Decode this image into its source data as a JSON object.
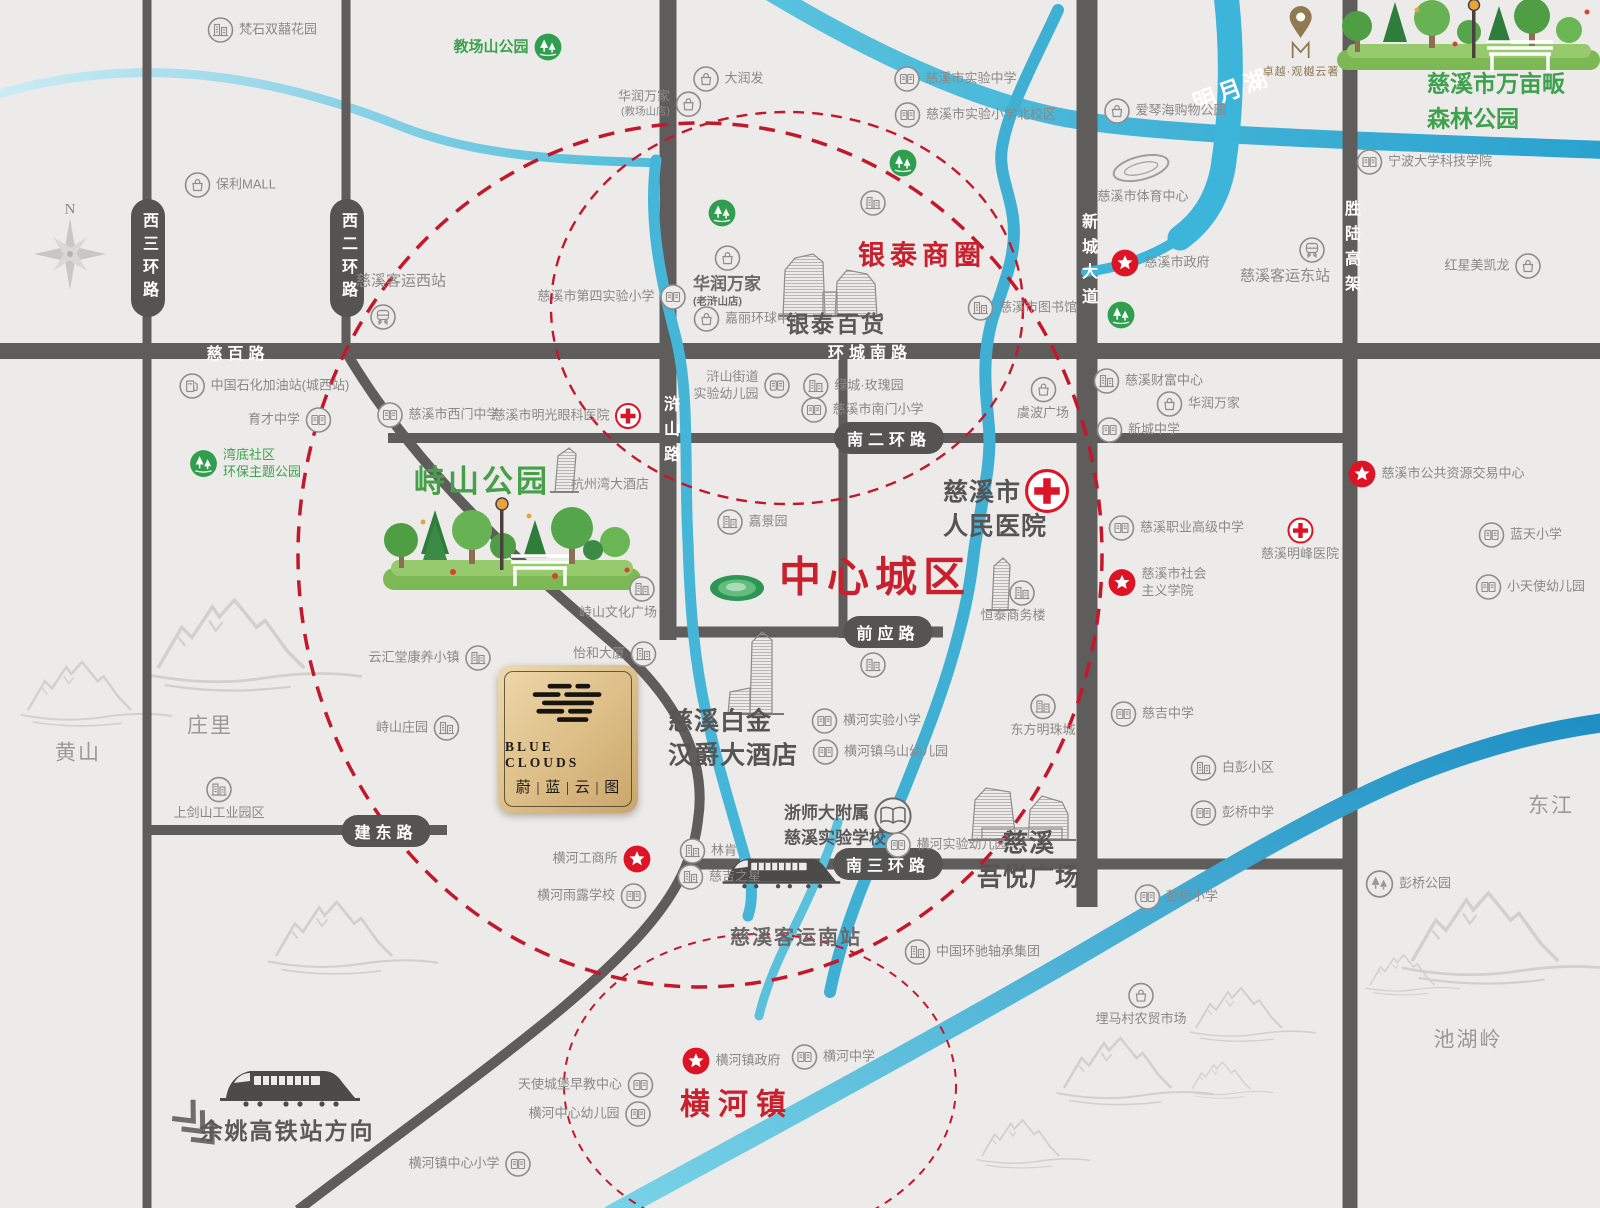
{
  "plaque": {
    "en": "BLUE CLOUDS",
    "zh": "蔚 | 蓝 | 云 | 图"
  },
  "pin": {
    "label": "卓越·观樾云著"
  },
  "road_labels": [
    {
      "n": "xisan-huanlu",
      "t": "西三环路",
      "k": "pv",
      "x": 148,
      "y": 258
    },
    {
      "n": "xier-huanlu",
      "t": "西二环路",
      "k": "pv",
      "x": 347,
      "y": 258
    },
    {
      "n": "cibai-lu",
      "t": "慈百路",
      "k": "rh",
      "x": 238,
      "y": 352
    },
    {
      "n": "huancheng-nanlu",
      "t": "环城南路",
      "k": "rh",
      "x": 870,
      "y": 351
    },
    {
      "n": "hushan-lu",
      "t": "浒山路",
      "k": "rv",
      "x": 669,
      "y": 433
    },
    {
      "n": "xincheng-dadao",
      "t": "新城大道",
      "k": "rv",
      "x": 1087,
      "y": 263
    },
    {
      "n": "shenglu-gaojia",
      "t": "胜陆高架",
      "k": "rv",
      "x": 1350,
      "y": 250
    },
    {
      "n": "naner-huanlu",
      "t": "南二环路",
      "k": "ph",
      "x": 889,
      "y": 438
    },
    {
      "n": "qianying-lu",
      "t": "前应路",
      "k": "ph",
      "x": 888,
      "y": 632
    },
    {
      "n": "nansan-huanlu",
      "t": "南三环路",
      "k": "ph",
      "x": 888,
      "y": 864
    },
    {
      "n": "jiandong-lu",
      "t": "建东路",
      "k": "ph",
      "x": 386,
      "y": 831
    },
    {
      "n": "mingyuehu",
      "t": "明月湖",
      "k": "wl",
      "x": 1231,
      "y": 88,
      "rot": -20
    }
  ],
  "pois": [
    {
      "n": "fanshi-shuangxi-huayuan",
      "t": "梵石双囍花园",
      "i": "building",
      "ip": "l",
      "x": 262,
      "y": 30
    },
    {
      "n": "baoli-mall",
      "t": "保利MALL",
      "i": "bag",
      "ip": "l",
      "x": 230,
      "y": 185
    },
    {
      "n": "compass-label",
      "t": "N",
      "x": 70,
      "y": 210,
      "c": "compass-n"
    },
    {
      "n": "jiaochangshan-gongyuan",
      "t": "教场山公园",
      "i": "park",
      "ip": "r",
      "x": 508,
      "y": 47,
      "c": "green-md"
    },
    {
      "n": "darunfa",
      "t": "大润发",
      "i": "bag",
      "ip": "l",
      "x": 728,
      "y": 79
    },
    {
      "n": "huarun-wanjia-jiaochangshan",
      "t": "华润万家",
      "s": "(教场山店)",
      "i": "bag",
      "ip": "r",
      "x": 660,
      "y": 104,
      "la": "r"
    },
    {
      "n": "cixi-keyun-xizhan",
      "t": "慈溪客运西站",
      "x": 401,
      "y": 281,
      "c": "gray-md"
    },
    {
      "n": "xizhan-train",
      "i": "train",
      "x": 383,
      "y": 317
    },
    {
      "n": "cixi-disi-shiyan-xiaoxue",
      "t": "慈溪市第四实验小学",
      "i": "school",
      "ip": "r",
      "x": 612,
      "y": 297
    },
    {
      "n": "jiali-huanqiu-zhongxin",
      "t": "嘉丽环球中心",
      "i": "bag",
      "ip": "l",
      "x": 748,
      "y": 319
    },
    {
      "n": "huarun-wanjia-laohushan",
      "t": "华润万家",
      "s": "(老浒山店)",
      "i": "bag",
      "ip": "a",
      "x": 727,
      "y": 277,
      "c": "hd",
      "la": "l"
    },
    {
      "n": "yintai-baihuo",
      "t": "银泰百货",
      "x": 836,
      "y": 325,
      "c": "dark-lg"
    },
    {
      "n": "cixi-shiyan-zhongxue",
      "t": "慈溪市实验中学",
      "i": "school",
      "ip": "l",
      "x": 955,
      "y": 79
    },
    {
      "n": "cixi-shiyan-xiaoxue-beixiaoqu",
      "t": "慈溪市实验小学北校区",
      "i": "school",
      "ip": "l",
      "x": 975,
      "y": 115
    },
    {
      "n": "aiqinhai-gouwu-gongyuan",
      "t": "爱琴海购物公园",
      "i": "bag",
      "ip": "l",
      "x": 1165,
      "y": 111
    },
    {
      "n": "yintai-shangquan",
      "t": "银泰商圈",
      "x": 922,
      "y": 256,
      "c": "red-lg"
    },
    {
      "n": "cixi-tiyu-zhongxin",
      "t": "慈溪市体育中心",
      "x": 1143,
      "y": 197
    },
    {
      "n": "cixi-zhengfu",
      "t": "慈溪市政府",
      "i": "star",
      "ip": "l",
      "x": 1160,
      "y": 263
    },
    {
      "n": "cixi-keyun-dongzhan",
      "t": "慈溪客运东站",
      "x": 1285,
      "y": 276,
      "c": "gray-md"
    },
    {
      "n": "dongzhan-train",
      "i": "train",
      "x": 1312,
      "y": 250
    },
    {
      "n": "cixi-wanmupan-senlin-gongyuan",
      "t": "慈溪市万亩畈",
      "t2": "森林公园",
      "x": 1496,
      "y": 101,
      "c": "green-hd",
      "la": "l"
    },
    {
      "n": "ningbo-daxue-keji-xueyuan",
      "t": "宁波大学科技学院",
      "i": "school",
      "ip": "l",
      "x": 1424,
      "y": 162
    },
    {
      "n": "hongxing-meikailong",
      "t": "红星美凯龙",
      "i": "bag",
      "ip": "r",
      "x": 1493,
      "y": 266
    },
    {
      "n": "zhongguo-shihua-jiayouzhan",
      "t": "中国石化加油站(城西站)",
      "i": "gas",
      "ip": "l",
      "x": 264,
      "y": 386
    },
    {
      "n": "yucai-zhongxue",
      "t": "育才中学",
      "i": "school",
      "ip": "r",
      "x": 290,
      "y": 420
    },
    {
      "n": "wandi-shequ-huanbao-gongyuan",
      "t": "湾底社区",
      "t2": "环保主题公园",
      "i": "park",
      "ip": "l",
      "x": 245,
      "y": 464,
      "c": "green",
      "la": "l"
    },
    {
      "n": "cixi-ximen-zhongxue",
      "t": "慈溪市西门中学",
      "i": "school",
      "ip": "l",
      "x": 438,
      "y": 415
    },
    {
      "n": "cixi-mingguang-yanke-yiyuan",
      "t": "慈溪市明光眼科医院",
      "i": "cross",
      "ip": "r",
      "x": 567,
      "y": 416
    },
    {
      "n": "hushan-jiedao-shiyan-youeryuan",
      "t": "浒山街道",
      "t2": "实验幼儿园",
      "i": "school",
      "ip": "r",
      "x": 742,
      "y": 386,
      "la": "r"
    },
    {
      "n": "lvcheng-meiguiyuan",
      "t": "绿城·玫瑰园",
      "i": "building",
      "ip": "l",
      "x": 853,
      "y": 386
    },
    {
      "n": "cixi-nanmen-xiaoxue",
      "t": "慈溪市南门小学",
      "i": "school",
      "ip": "l",
      "x": 862,
      "y": 410
    },
    {
      "n": "yubo-guangchang",
      "t": "虞波广场",
      "i": "bag",
      "ip": "a",
      "x": 1043,
      "y": 399
    },
    {
      "n": "cixi-tushuguan",
      "t": "慈溪市图书馆",
      "i": "building",
      "ip": "l",
      "x": 1022,
      "y": 308
    },
    {
      "n": "cixi-caifu-zhongxin",
      "t": "慈溪财富中心",
      "i": "building",
      "ip": "l",
      "x": 1148,
      "y": 381
    },
    {
      "n": "huarun-wanjia",
      "t": "华润万家",
      "i": "bag",
      "ip": "l",
      "x": 1198,
      "y": 404
    },
    {
      "n": "xincheng-zhongxue",
      "t": "新城中学",
      "i": "school",
      "ip": "l",
      "x": 1138,
      "y": 430
    },
    {
      "n": "cixi-gonggong-ziyuan-jiaoyi-zhongxin",
      "t": "慈溪市公共资源交易中心",
      "i": "star",
      "ip": "l",
      "x": 1436,
      "y": 474
    },
    {
      "n": "lantian-xiaoxue",
      "t": "蓝天小学",
      "i": "school",
      "ip": "l",
      "x": 1520,
      "y": 535
    },
    {
      "n": "xiaotianshi-youeryuan",
      "t": "小天使幼儿园",
      "i": "school",
      "ip": "l",
      "x": 1530,
      "y": 587
    },
    {
      "n": "cixi-zhiye-gaoji-zhongxue",
      "t": "慈溪职业高级中学",
      "i": "school",
      "ip": "l",
      "x": 1176,
      "y": 528
    },
    {
      "n": "cixi-mingfeng-yiyuan",
      "t": "慈溪明峰医院",
      "i": "cross",
      "ip": "a",
      "x": 1300,
      "y": 540
    },
    {
      "n": "cixi-shehuizhuyi-xueyuan",
      "t": "慈溪市社会",
      "t2": "主义学院",
      "i": "star",
      "ip": "l",
      "x": 1157,
      "y": 583,
      "la": "l"
    },
    {
      "n": "zhishan-gongyuan",
      "t": "峙山公园",
      "x": 482,
      "y": 482,
      "c": "green-xl"
    },
    {
      "n": "hangzhouwan-dajiudian",
      "t": "杭州湾大酒店",
      "x": 610,
      "y": 485
    },
    {
      "n": "jiajingyuan",
      "t": "嘉景园",
      "i": "building",
      "ip": "l",
      "x": 752,
      "y": 522
    },
    {
      "n": "zhongxin-chengqu",
      "t": "中心城区",
      "x": 875,
      "y": 578,
      "c": "red-xl"
    },
    {
      "n": "cixi-renmin-yiyuan",
      "t": "慈溪市",
      "t2": "人民医院",
      "x": 995,
      "y": 510,
      "c": "dark-xl",
      "la": "l"
    },
    {
      "n": "renmin-yiyuan-cross",
      "i": "cross-lg",
      "x": 1047,
      "y": 491
    },
    {
      "n": "hengtai-shangwulou",
      "t": "恒泰商务楼",
      "x": 1013,
      "y": 616
    },
    {
      "n": "hengtai-icon",
      "i": "building",
      "x": 1022,
      "y": 593
    },
    {
      "n": "zhishan-wenhua-guangchang",
      "t": "峙山文化广场",
      "x": 618,
      "y": 613
    },
    {
      "n": "zhishan-wenhua-guangchang-icon",
      "i": "building",
      "x": 642,
      "y": 589
    },
    {
      "n": "yihe-dasha",
      "t": "怡和大厦",
      "i": "building",
      "ip": "r",
      "x": 615,
      "y": 654
    },
    {
      "n": "yunhuitang-kangyang-xiaozhen",
      "t": "云汇堂康养小镇",
      "i": "building",
      "ip": "r",
      "x": 430,
      "y": 658
    },
    {
      "n": "zhishan-zhuangyuan",
      "t": "峙山庄园",
      "i": "building",
      "ip": "r",
      "x": 418,
      "y": 728
    },
    {
      "n": "cixi-baijin-hanjue-dajiudian",
      "t": "慈溪白金",
      "t2": "汉爵大酒店",
      "x": 733,
      "y": 739,
      "c": "dark-xl",
      "la": "l"
    },
    {
      "n": "henghe-shiyan-xiaoxue",
      "t": "横河实验小学",
      "i": "school",
      "ip": "l",
      "x": 866,
      "y": 721
    },
    {
      "n": "henghezhen-wushan-youeryuan",
      "t": "横河镇乌山幼儿园",
      "i": "school",
      "ip": "l",
      "x": 880,
      "y": 752
    },
    {
      "n": "dongfang-mingzhucheng",
      "t": "东方明珠城",
      "i": "building",
      "ip": "a",
      "x": 1043,
      "y": 716
    },
    {
      "n": "ciji-zhongxue",
      "t": "慈吉中学",
      "i": "school",
      "ip": "l",
      "x": 1152,
      "y": 714
    },
    {
      "n": "baipeng-xiaoqu",
      "t": "白彭小区",
      "i": "building",
      "ip": "l",
      "x": 1232,
      "y": 768
    },
    {
      "n": "pengqiao-zhongxue",
      "t": "彭桥中学",
      "i": "school",
      "ip": "l",
      "x": 1232,
      "y": 813
    },
    {
      "n": "huangshan",
      "t": "黄山",
      "x": 78,
      "y": 753,
      "c": "gray-lg"
    },
    {
      "n": "zhuangli",
      "t": "庄里",
      "x": 210,
      "y": 726,
      "c": "gray-lg"
    },
    {
      "n": "shangjianshan-gongye-yuanqu",
      "t": "上剑山工业园区",
      "i": "building",
      "ip": "a",
      "x": 219,
      "y": 799
    },
    {
      "n": "henghe-gongshangsuo",
      "t": "横河工商所",
      "i": "star",
      "ip": "r",
      "x": 602,
      "y": 859
    },
    {
      "n": "henghe-yulu-xuexiao",
      "t": "横河雨露学校",
      "i": "school",
      "ip": "r",
      "x": 592,
      "y": 896
    },
    {
      "n": "linken",
      "t": "林肯",
      "i": "building",
      "ip": "l",
      "x": 708,
      "y": 851
    },
    {
      "n": "ciji-zhixing",
      "t": "慈吉之星",
      "i": "building",
      "ip": "l",
      "x": 719,
      "y": 877
    },
    {
      "n": "zheshida-fushu-cixi-shiyan-xuexiao",
      "t": "浙师大附属",
      "t2": "慈溪实验学校",
      "x": 835,
      "y": 826,
      "c": "md-dark",
      "la": "l"
    },
    {
      "n": "zheshida-book",
      "i": "book",
      "x": 893,
      "y": 816
    },
    {
      "n": "henghe-shiyan-youeryuan",
      "t": "横河实验幼儿园",
      "i": "school",
      "ip": "l",
      "x": 946,
      "y": 845
    },
    {
      "n": "cixi-wuyue-guangchang",
      "t": "慈溪",
      "t2": "吾悦广场",
      "x": 1029,
      "y": 861,
      "c": "dark-xl"
    },
    {
      "n": "pengqiao-xiaoxue",
      "t": "彭桥小学",
      "i": "school",
      "ip": "l",
      "x": 1176,
      "y": 897
    },
    {
      "n": "pengqiao-gongyuan",
      "t": "彭桥公园",
      "i": "trees",
      "ip": "l",
      "x": 1408,
      "y": 884
    },
    {
      "n": "cixi-keyun-nanzhan",
      "t": "慈溪客运南站",
      "x": 796,
      "y": 938,
      "c": "dark-md"
    },
    {
      "n": "zhongguo-huanchi-zhoucheng-jituan",
      "t": "中国环驰轴承集团",
      "i": "building",
      "ip": "l",
      "x": 972,
      "y": 952
    },
    {
      "n": "henghe-zhongxue",
      "t": "横河中学",
      "i": "school",
      "ip": "l",
      "x": 833,
      "y": 1057
    },
    {
      "n": "maima-cun-nongmao-shichang",
      "t": "埋马村农贸市场",
      "i": "bag",
      "ip": "a",
      "x": 1141,
      "y": 1005
    },
    {
      "n": "henghezhen-zhengfu",
      "t": "横河镇政府",
      "i": "star",
      "ip": "l",
      "x": 731,
      "y": 1061
    },
    {
      "n": "henghezhen",
      "t": "横河镇",
      "x": 737,
      "y": 1105,
      "c": "red-md"
    },
    {
      "n": "tianshi-chengbao-zaojiao-zhongxin",
      "t": "天使城堡早教中心",
      "i": "school",
      "ip": "r",
      "x": 586,
      "y": 1085
    },
    {
      "n": "henghe-zhongxin-youeryuan",
      "t": "横河中心幼儿园",
      "i": "school",
      "ip": "r",
      "x": 590,
      "y": 1114
    },
    {
      "n": "henghezhen-zhongxin-xiaoxue",
      "t": "横河镇中心小学",
      "i": "school",
      "ip": "r",
      "x": 470,
      "y": 1164
    },
    {
      "n": "yuyao-gaotiezhan-fangxiang",
      "t": "余姚高铁站方向",
      "x": 287,
      "y": 1132,
      "c": "dark-hd"
    },
    {
      "n": "chihuling",
      "t": "池湖岭",
      "x": 1468,
      "y": 1040,
      "c": "gray-lg"
    },
    {
      "n": "dongjiang",
      "t": "东江",
      "x": 1551,
      "y": 806,
      "c": "gray-lg"
    },
    {
      "n": "park-icon-1",
      "i": "park",
      "x": 903,
      "y": 163
    },
    {
      "n": "park-icon-2",
      "i": "park",
      "x": 722,
      "y": 213
    },
    {
      "n": "park-icon-3",
      "i": "park",
      "x": 1121,
      "y": 315
    },
    {
      "n": "building-icon-1",
      "i": "building",
      "x": 873,
      "y": 203
    },
    {
      "n": "building-icon-2",
      "i": "building",
      "x": 873,
      "y": 665
    }
  ]
}
